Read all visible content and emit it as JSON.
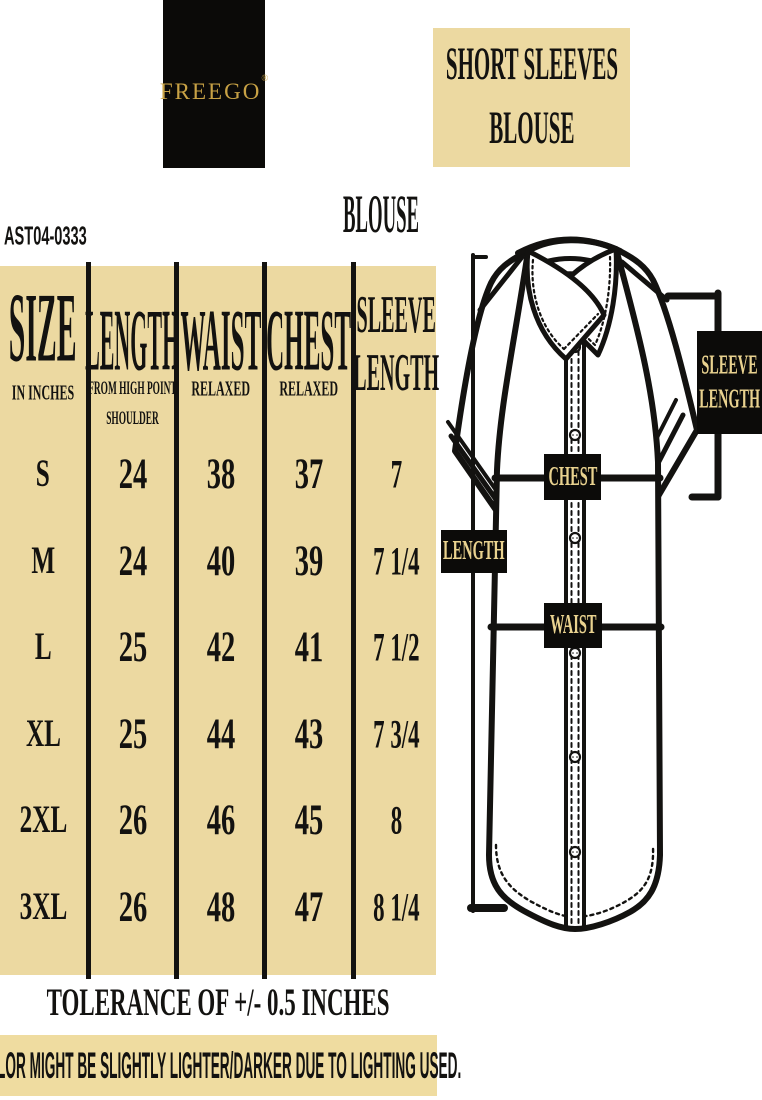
{
  "brand": {
    "logo_text": "FREEGO",
    "registered_mark": "®"
  },
  "product": {
    "code": "AST04-0333",
    "category_title": "BLOUSE",
    "diagram_title_line1": "SHORT SLEEVES",
    "diagram_title_line2": "BLOUSE"
  },
  "size_table": {
    "columns": [
      {
        "title": "SIZE",
        "subtitle": "IN INCHES",
        "values": [
          "S",
          "M",
          "L",
          "XL",
          "2XL",
          "3XL"
        ]
      },
      {
        "title": "LENGTH",
        "subtitle_lines": [
          "FROM HIGH POINT",
          "SHOULDER"
        ],
        "values": [
          "24",
          "24",
          "25",
          "25",
          "26",
          "26"
        ]
      },
      {
        "title": "WAIST",
        "subtitle": "RELAXED",
        "values": [
          "38",
          "40",
          "42",
          "44",
          "46",
          "48"
        ]
      },
      {
        "title": "CHEST",
        "subtitle": "RELAXED",
        "values": [
          "37",
          "39",
          "41",
          "43",
          "45",
          "47"
        ]
      },
      {
        "title_line1": "SLEEVE",
        "title_line2": "LENGTH",
        "values": [
          "7",
          "7 1/4",
          "7 1/2",
          "7 3/4",
          "8",
          "8 1/4"
        ]
      }
    ]
  },
  "diagram": {
    "labels": {
      "sleeve_length_line1": "SLEEVE",
      "sleeve_length_line2": "LENGTH",
      "chest": "CHEST",
      "length": "LENGTH",
      "waist": "WAIST"
    }
  },
  "notes": {
    "tolerance": "TOLERANCE OF +/- 0.5 INCHES",
    "disclaimer": "COLOR MIGHT BE SLIGHTLY LIGHTER/DARKER DUE TO LIGHTING USED."
  },
  "colors": {
    "tan": "#ecd9a1",
    "black": "#0b0a08",
    "logo_gold": "#c8a245",
    "label_text": "#e9d28f"
  }
}
